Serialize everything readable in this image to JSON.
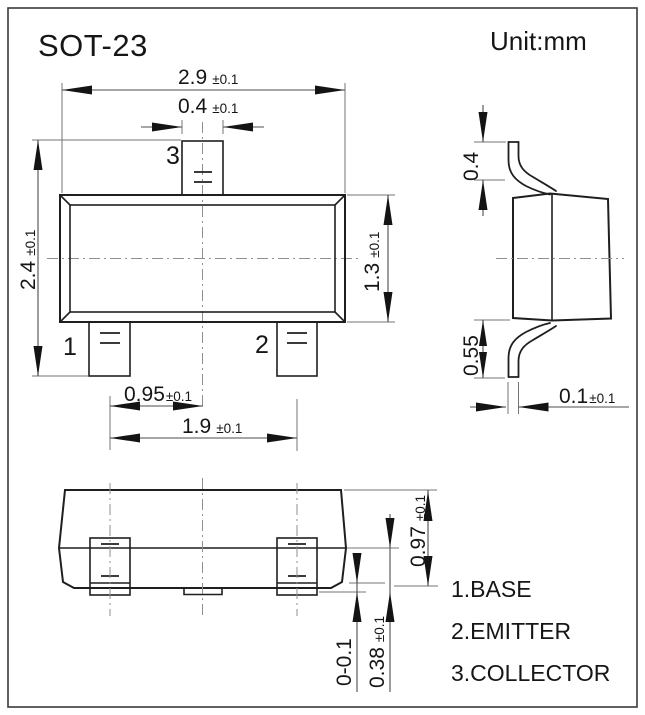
{
  "title": "SOT-23",
  "unit": "Unit:mm",
  "front": {
    "dim_width": {
      "value": "2.9",
      "tol": "±0.1"
    },
    "dim_tab": {
      "value": "0.4",
      "tol": "±0.1"
    },
    "dim_height": {
      "value": "2.4",
      "tol": "±0.1"
    },
    "dim_body": {
      "value": "1.3",
      "tol": "±0.1"
    },
    "dim_pitch": {
      "value": "0.95",
      "tol": "±0.1"
    },
    "dim_span": {
      "value": "1.9",
      "tol": "±0.1"
    },
    "pin1": "1",
    "pin2": "2",
    "pin3": "3"
  },
  "side": {
    "dim_top_lead": "0.4",
    "dim_bottom_lead": "0.55",
    "dim_thickness": {
      "value": "0.1",
      "tol": "±0.1"
    }
  },
  "bottom": {
    "dim_height": {
      "value": "0.97",
      "tol": "±0.1"
    },
    "dim_standoff": "0-0.1",
    "dim_foot": {
      "value": "0.38",
      "tol": "±0.1"
    }
  },
  "legend": {
    "items": [
      "1.BASE",
      "2.EMITTER",
      "3.COLLECTOR"
    ]
  }
}
